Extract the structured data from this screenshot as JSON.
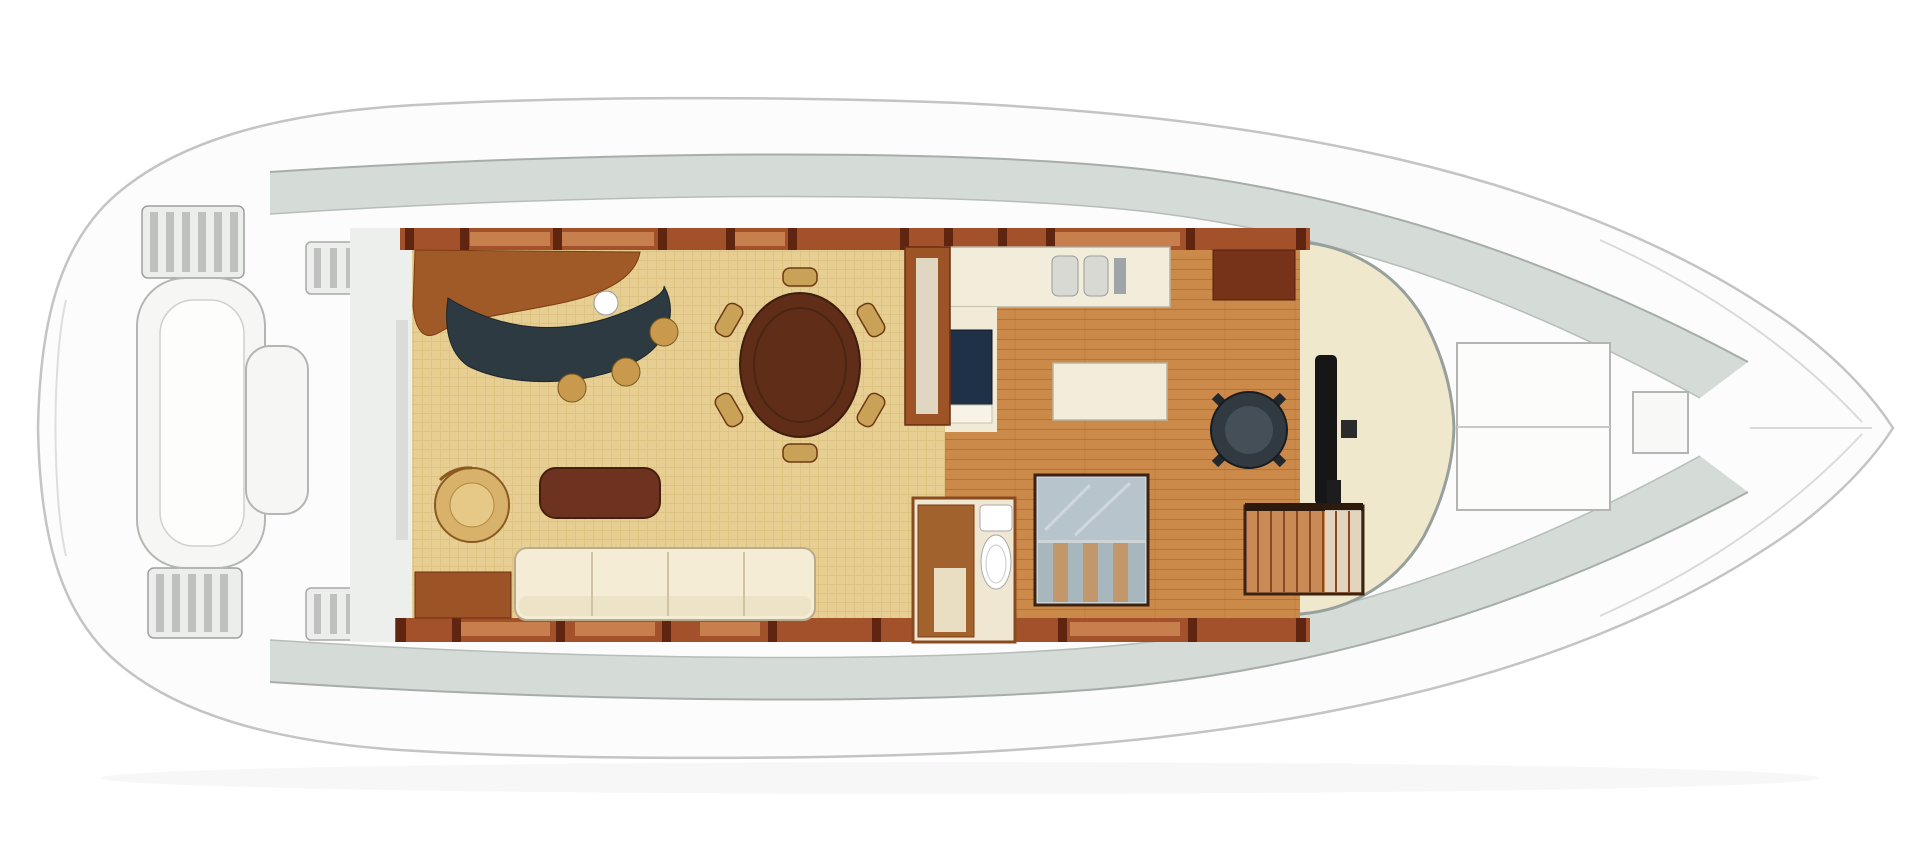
{
  "diagram": {
    "kind": "yacht-main-deck-floor-plan",
    "orientation": "bow-right"
  },
  "colors": {
    "page_bg": "#ffffff",
    "hull_fill": "#fbfcfb",
    "hull_line": "#c2c5c2",
    "hull_line_inner": "#d9dbd9",
    "deck_band": "#d3d9d5",
    "deck_band_edge": "#a7aea9",
    "slat_fill": "#eceeec",
    "slat_bar": "#b6bab7",
    "bench_fill": "#f6f7f5",
    "bench_line": "#b3b6b3",
    "carpet": "#e7cf93",
    "carpet_line": "#d8ba74",
    "plank": "#cc8a4a",
    "plank_line": "#a96229",
    "wall_wood": "#a3512a",
    "wall_post": "#5f2510",
    "window_wood": "#c87f4e",
    "bulkhead": "#edefec",
    "bar_wood": "#a05a28",
    "bar_counter": "#2d3a42",
    "sink_white": "#ffffff",
    "stool": "#c99a4e",
    "stool_edge": "#7c5a1c",
    "table_wood": "#5f2d18",
    "chair_tan": "#c9a257",
    "chair_edge": "#6b3a12",
    "coffee_table": "#6e3320",
    "armchair": "#d8b26b",
    "armchair_inner": "#e6c987",
    "sofa": "#f4ecd4",
    "sofa_edge": "#b9ac8e",
    "cream_counter": "#f2edda",
    "counter_edge": "#b9b3a0",
    "appliance_gray": "#9fa4a8",
    "cabinet_dark": "#77321a",
    "tv_navy": "#1f3147",
    "alcove": "#f1ead6",
    "head_floor": "#efe7d2",
    "head_wood": "#a2622e",
    "fixture_edge": "#a9a9a9",
    "stairs_frame": "#3a2313",
    "stairs_landing": "#b7c4cb",
    "tread_gray": "#a8b6bd",
    "tread_wood": "#c2986a",
    "stairs2_wood": "#c98a55",
    "stairs2_light": "#e8e0d2",
    "pilothouse": "#f0e8cd",
    "windshield": "#98a09b",
    "dashboard": "#161616",
    "helm_chair": "#323a41",
    "helm_chair_dark": "#171c20",
    "helm_chair_inner": "#454f57",
    "hatch_fill": "#fcfcfa",
    "hatch_edge": "#b5b5b5"
  }
}
